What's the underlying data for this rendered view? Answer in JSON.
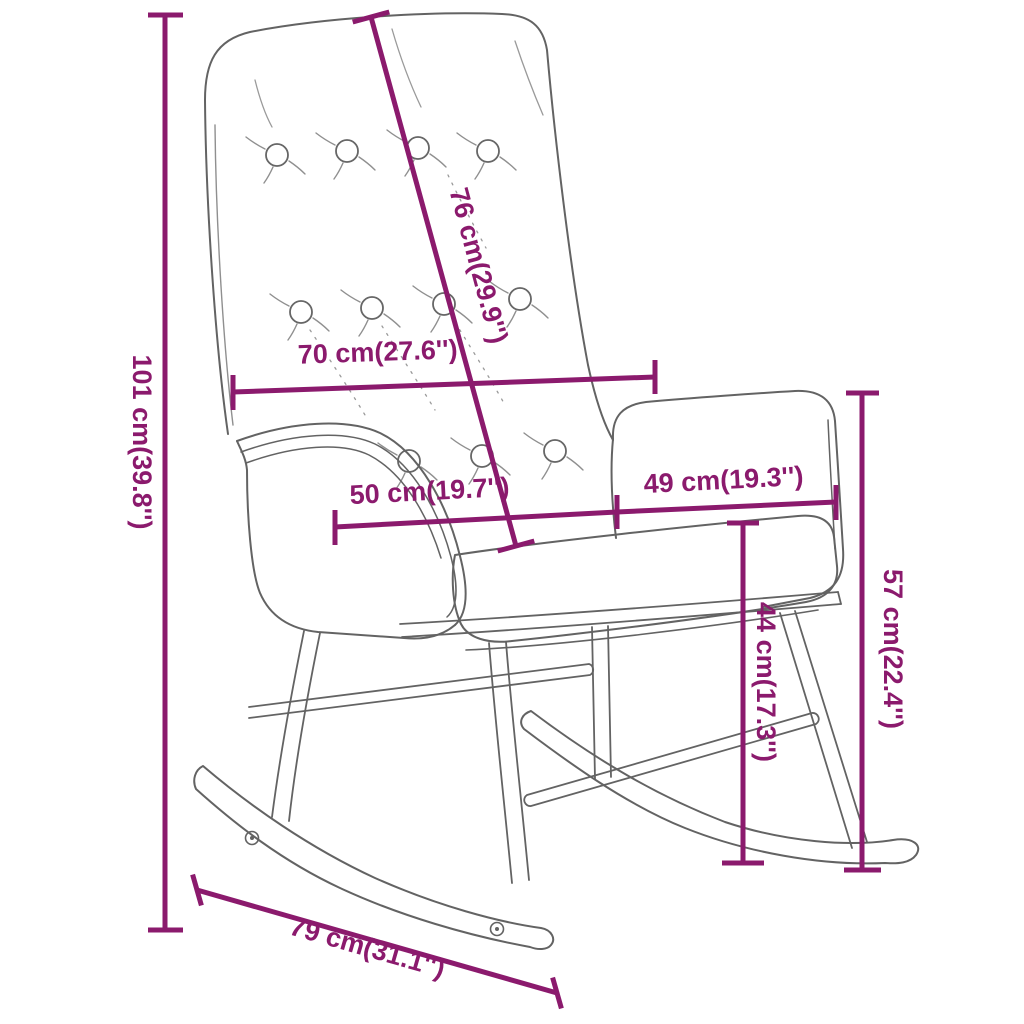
{
  "diagram": {
    "type": "product-dimension-diagram",
    "subject": "rocking-chair-line-drawing",
    "colors": {
      "dimension": "#8b1a6d",
      "outline": "#636363",
      "crease": "#8f8f8f",
      "background": "#ffffff"
    },
    "dimensions": [
      {
        "id": "total-height",
        "label": "101 cm(39.8'')"
      },
      {
        "id": "backrest-diagonal",
        "label": "76 cm(29.9'')"
      },
      {
        "id": "backrest-width",
        "label": "70 cm(27.6'')"
      },
      {
        "id": "seat-width",
        "label": "50 cm(19.7'')"
      },
      {
        "id": "armrest-width",
        "label": "49 cm(19.3'')"
      },
      {
        "id": "seat-height",
        "label": "44 cm(17.3'')"
      },
      {
        "id": "armrest-height",
        "label": "57 cm(22.4'')"
      },
      {
        "id": "rocker-length",
        "label": "79 cm(31.1'')"
      }
    ]
  }
}
